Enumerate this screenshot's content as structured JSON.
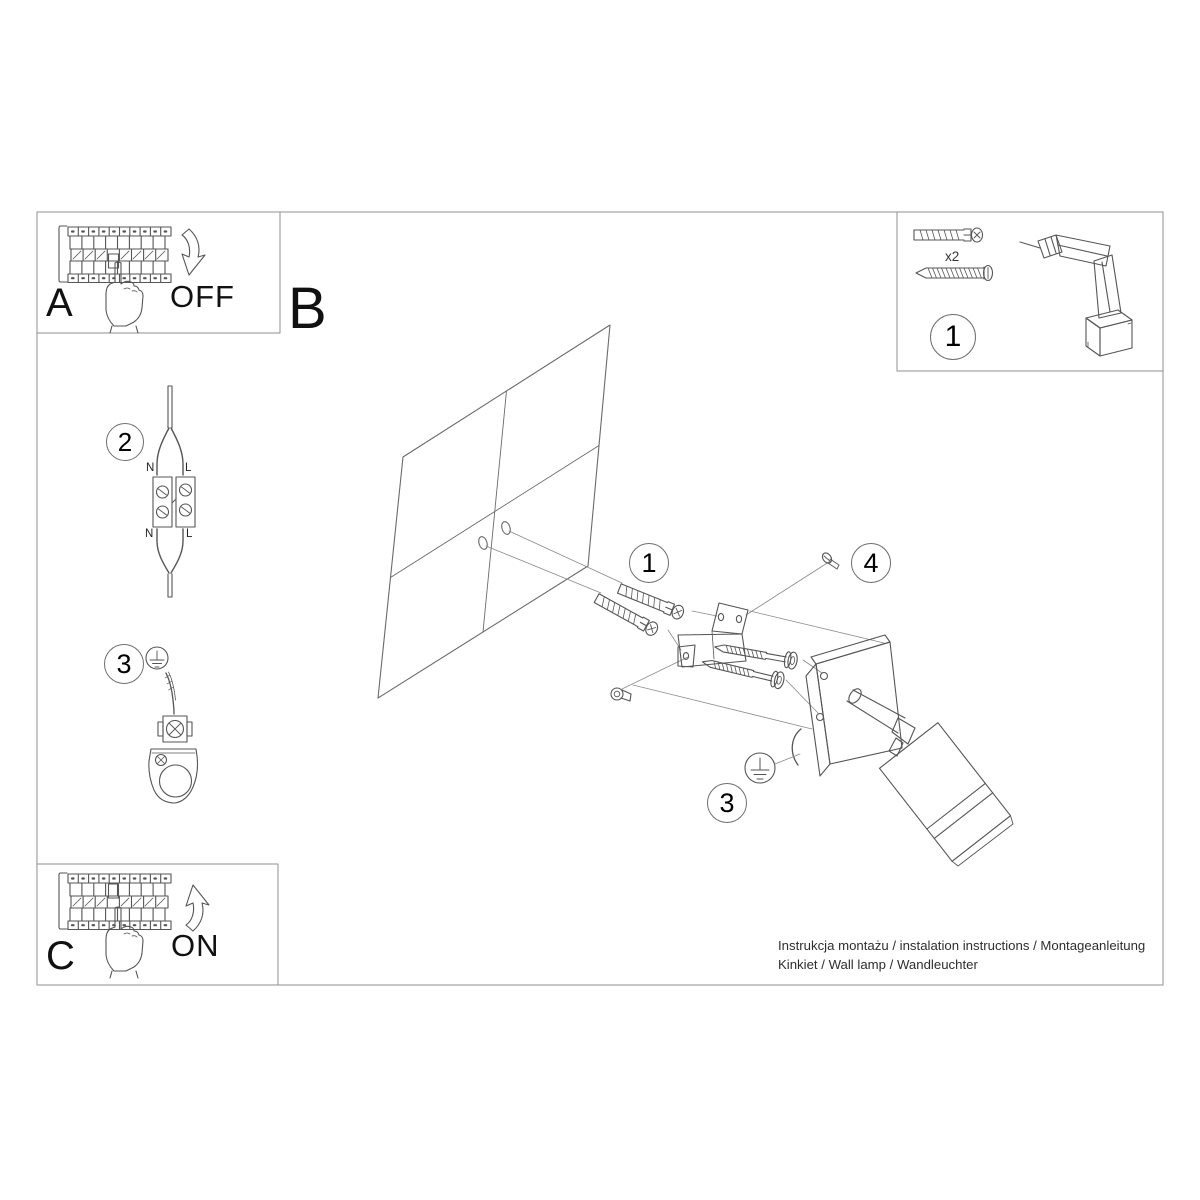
{
  "colors": {
    "background": "#ffffff",
    "line_art": "#555555",
    "frame": "#8f8f8f",
    "text": "#1a1a1a"
  },
  "panels": {
    "step_a": {
      "label": "A",
      "caption": "OFF"
    },
    "step_b": {
      "label": "B"
    },
    "step_c": {
      "label": "C",
      "caption": "ON"
    },
    "parts_box": {
      "marker": "1",
      "quantity": "x2"
    }
  },
  "steps": {
    "wiring": {
      "marker": "2",
      "terminal_labels": {
        "top_left": "N",
        "top_right": "L",
        "bottom_left": "N",
        "bottom_right": "L"
      }
    },
    "earth": {
      "marker": "3"
    }
  },
  "callouts": {
    "anchors_marker": "1",
    "adjust_screw_marker": "4",
    "earth_wire_marker": "3"
  },
  "footer": {
    "line1": "Instrukcja montażu / instalation instructions / Montageanleitung",
    "line2": "Kinkiet / Wall lamp / Wandleuchter"
  }
}
